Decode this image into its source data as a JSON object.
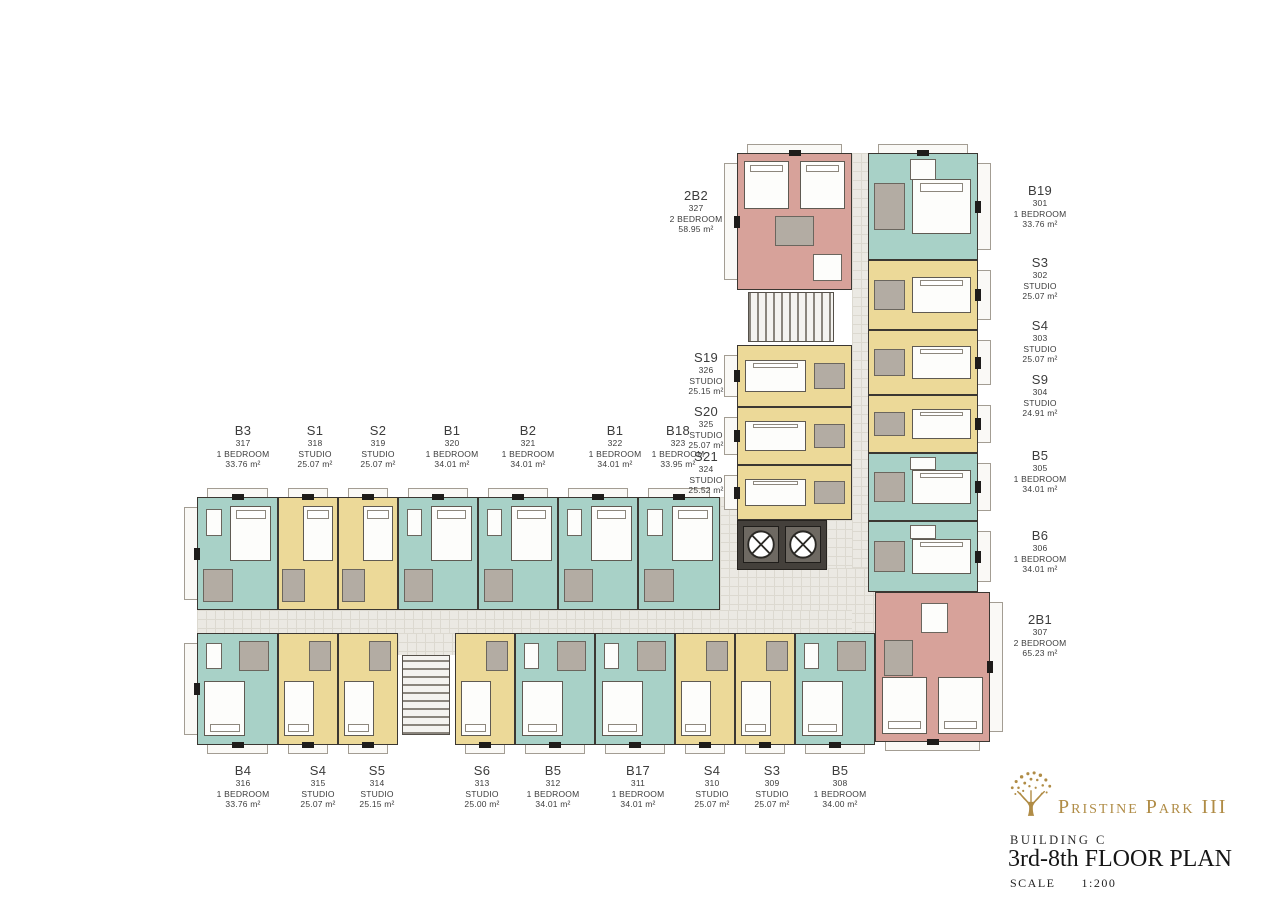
{
  "palette": {
    "teal": "#a8d1c7",
    "yellow": "#ecd998",
    "pink": "#d7a29a",
    "bath": "#b3aca3",
    "corridor": "#ebe9e3",
    "wall": "#3b3732",
    "gold": "#b08c46"
  },
  "title_block": {
    "project": "Pristine Park III",
    "building": "BUILDING C",
    "floor_plan": "3rd-8th FLOOR PLAN",
    "scale_label": "SCALE",
    "scale_value": "1:200"
  },
  "units": [
    {
      "code": "B19",
      "no": "301",
      "type": "1 BEDROOM",
      "area": "33.76 m²",
      "color": "teal",
      "side": "right",
      "tabs": [
        "top",
        "right"
      ],
      "block": {
        "x": 868,
        "y": 153,
        "w": 110,
        "h": 107
      },
      "label": {
        "cx": 1040,
        "y": 183
      }
    },
    {
      "code": "S3",
      "no": "302",
      "type": "STUDIO",
      "area": "25.07 m²",
      "color": "yellow",
      "side": "right",
      "tabs": [
        "right"
      ],
      "block": {
        "x": 868,
        "y": 260,
        "w": 110,
        "h": 70
      },
      "label": {
        "cx": 1040,
        "y": 255
      }
    },
    {
      "code": "S4",
      "no": "303",
      "type": "STUDIO",
      "area": "25.07 m²",
      "color": "yellow",
      "side": "right",
      "tabs": [
        "right"
      ],
      "block": {
        "x": 868,
        "y": 330,
        "w": 110,
        "h": 65
      },
      "label": {
        "cx": 1040,
        "y": 318
      }
    },
    {
      "code": "S9",
      "no": "304",
      "type": "STUDIO",
      "area": "24.91 m²",
      "color": "yellow",
      "side": "right",
      "tabs": [
        "right"
      ],
      "block": {
        "x": 868,
        "y": 395,
        "w": 110,
        "h": 58
      },
      "label": {
        "cx": 1040,
        "y": 372
      }
    },
    {
      "code": "B5",
      "no": "305",
      "type": "1 BEDROOM",
      "area": "34.01 m²",
      "color": "teal",
      "side": "right",
      "tabs": [
        "right"
      ],
      "block": {
        "x": 868,
        "y": 453,
        "w": 110,
        "h": 68
      },
      "label": {
        "cx": 1040,
        "y": 448
      }
    },
    {
      "code": "B6",
      "no": "306",
      "type": "1 BEDROOM",
      "area": "34.01 m²",
      "color": "teal",
      "side": "right",
      "tabs": [
        "right"
      ],
      "block": {
        "x": 868,
        "y": 521,
        "w": 110,
        "h": 71
      },
      "label": {
        "cx": 1040,
        "y": 528
      }
    },
    {
      "code": "2B1",
      "no": "307",
      "type": "2 BEDROOM",
      "area": "65.23 m²",
      "color": "pink",
      "side": "corner",
      "tabs": [
        "right",
        "bottom"
      ],
      "block": {
        "x": 875,
        "y": 592,
        "w": 115,
        "h": 150
      },
      "label": {
        "cx": 1040,
        "y": 612
      }
    },
    {
      "code": "B5",
      "no": "308",
      "type": "1 BEDROOM",
      "area": "34.00 m²",
      "color": "teal",
      "side": "bottom",
      "tabs": [
        "bottom"
      ],
      "block": {
        "x": 795,
        "y": 633,
        "w": 80,
        "h": 112
      },
      "label": {
        "cx": 840,
        "y": 763
      }
    },
    {
      "code": "S3",
      "no": "309",
      "type": "STUDIO",
      "area": "25.07 m²",
      "color": "yellow",
      "side": "bottom",
      "tabs": [
        "bottom"
      ],
      "block": {
        "x": 735,
        "y": 633,
        "w": 60,
        "h": 112
      },
      "label": {
        "cx": 772,
        "y": 763
      }
    },
    {
      "code": "S4",
      "no": "310",
      "type": "STUDIO",
      "area": "25.07 m²",
      "color": "yellow",
      "side": "bottom",
      "tabs": [
        "bottom"
      ],
      "block": {
        "x": 675,
        "y": 633,
        "w": 60,
        "h": 112
      },
      "label": {
        "cx": 712,
        "y": 763
      }
    },
    {
      "code": "B17",
      "no": "311",
      "type": "1 BEDROOM",
      "area": "34.01 m²",
      "color": "teal",
      "side": "bottom",
      "tabs": [
        "bottom"
      ],
      "block": {
        "x": 595,
        "y": 633,
        "w": 80,
        "h": 112
      },
      "label": {
        "cx": 638,
        "y": 763
      }
    },
    {
      "code": "B5",
      "no": "312",
      "type": "1 BEDROOM",
      "area": "34.01 m²",
      "color": "teal",
      "side": "bottom",
      "tabs": [
        "bottom"
      ],
      "block": {
        "x": 515,
        "y": 633,
        "w": 80,
        "h": 112
      },
      "label": {
        "cx": 553,
        "y": 763
      }
    },
    {
      "code": "S6",
      "no": "313",
      "type": "STUDIO",
      "area": "25.00 m²",
      "color": "yellow",
      "side": "bottom",
      "tabs": [
        "bottom"
      ],
      "block": {
        "x": 455,
        "y": 633,
        "w": 60,
        "h": 112
      },
      "label": {
        "cx": 482,
        "y": 763
      }
    },
    {
      "code": "S5",
      "no": "314",
      "type": "STUDIO",
      "area": "25.15 m²",
      "color": "yellow",
      "side": "bottom",
      "tabs": [
        "bottom"
      ],
      "block": {
        "x": 338,
        "y": 633,
        "w": 60,
        "h": 112
      },
      "label": {
        "cx": 377,
        "y": 763
      }
    },
    {
      "code": "S4",
      "no": "315",
      "type": "STUDIO",
      "area": "25.07 m²",
      "color": "yellow",
      "side": "bottom",
      "tabs": [
        "bottom"
      ],
      "block": {
        "x": 278,
        "y": 633,
        "w": 60,
        "h": 112
      },
      "label": {
        "cx": 318,
        "y": 763
      }
    },
    {
      "code": "B4",
      "no": "316",
      "type": "1 BEDROOM",
      "area": "33.76 m²",
      "color": "teal",
      "side": "bottom",
      "tabs": [
        "bottom",
        "left"
      ],
      "block": {
        "x": 197,
        "y": 633,
        "w": 81,
        "h": 112
      },
      "label": {
        "cx": 243,
        "y": 763
      }
    },
    {
      "code": "B3",
      "no": "317",
      "type": "1 BEDROOM",
      "area": "33.76 m²",
      "color": "teal",
      "side": "top",
      "tabs": [
        "top",
        "left"
      ],
      "block": {
        "x": 197,
        "y": 497,
        "w": 81,
        "h": 113
      },
      "label": {
        "cx": 243,
        "y": 423
      }
    },
    {
      "code": "S1",
      "no": "318",
      "type": "STUDIO",
      "area": "25.07 m²",
      "color": "yellow",
      "side": "top",
      "tabs": [
        "top"
      ],
      "block": {
        "x": 278,
        "y": 497,
        "w": 60,
        "h": 113
      },
      "label": {
        "cx": 315,
        "y": 423
      }
    },
    {
      "code": "S2",
      "no": "319",
      "type": "STUDIO",
      "area": "25.07 m²",
      "color": "yellow",
      "side": "top",
      "tabs": [
        "top"
      ],
      "block": {
        "x": 338,
        "y": 497,
        "w": 60,
        "h": 113
      },
      "label": {
        "cx": 378,
        "y": 423
      }
    },
    {
      "code": "B1",
      "no": "320",
      "type": "1 BEDROOM",
      "area": "34.01 m²",
      "color": "teal",
      "side": "top",
      "tabs": [
        "top"
      ],
      "block": {
        "x": 398,
        "y": 497,
        "w": 80,
        "h": 113
      },
      "label": {
        "cx": 452,
        "y": 423
      }
    },
    {
      "code": "B2",
      "no": "321",
      "type": "1 BEDROOM",
      "area": "34.01 m²",
      "color": "teal",
      "side": "top",
      "tabs": [
        "top"
      ],
      "block": {
        "x": 478,
        "y": 497,
        "w": 80,
        "h": 113
      },
      "label": {
        "cx": 528,
        "y": 423
      }
    },
    {
      "code": "B1",
      "no": "322",
      "type": "1 BEDROOM",
      "area": "34.01 m²",
      "color": "teal",
      "side": "top",
      "tabs": [
        "top"
      ],
      "block": {
        "x": 558,
        "y": 497,
        "w": 80,
        "h": 113
      },
      "label": {
        "cx": 615,
        "y": 423
      }
    },
    {
      "code": "B18",
      "no": "323",
      "type": "1 BEDROOM",
      "area": "33.95 m²",
      "color": "teal",
      "side": "top",
      "tabs": [
        "top"
      ],
      "block": {
        "x": 638,
        "y": 497,
        "w": 82,
        "h": 113
      },
      "label": {
        "cx": 678,
        "y": 423,
        "w": 70
      }
    },
    {
      "code": "S21",
      "no": "324",
      "type": "STUDIO",
      "area": "25.52 m²",
      "color": "yellow",
      "side": "left",
      "tabs": [
        "left"
      ],
      "block": {
        "x": 737,
        "y": 465,
        "w": 115,
        "h": 55
      },
      "label": {
        "cx": 706,
        "y": 449,
        "w": 70
      }
    },
    {
      "code": "S20",
      "no": "325",
      "type": "STUDIO",
      "area": "25.07 m²",
      "color": "yellow",
      "side": "left",
      "tabs": [
        "left"
      ],
      "block": {
        "x": 737,
        "y": 407,
        "w": 115,
        "h": 58
      },
      "label": {
        "cx": 706,
        "y": 404,
        "w": 70
      }
    },
    {
      "code": "S19",
      "no": "326",
      "type": "STUDIO",
      "area": "25.15 m²",
      "color": "yellow",
      "side": "left",
      "tabs": [
        "left"
      ],
      "block": {
        "x": 737,
        "y": 345,
        "w": 115,
        "h": 62
      },
      "label": {
        "cx": 706,
        "y": 350,
        "w": 70
      }
    },
    {
      "code": "2B2",
      "no": "327",
      "type": "2 BEDROOM",
      "area": "58.95 m²",
      "color": "pink",
      "side": "left",
      "tabs": [
        "left",
        "top"
      ],
      "block": {
        "x": 737,
        "y": 153,
        "w": 115,
        "h": 137
      },
      "label": {
        "cx": 696,
        "y": 188,
        "w": 86
      }
    }
  ],
  "structure": {
    "corridors": [
      {
        "x": 852,
        "y": 153,
        "w": 16,
        "h": 439
      },
      {
        "x": 720,
        "y": 497,
        "w": 17,
        "h": 113
      },
      {
        "x": 827,
        "y": 520,
        "w": 25,
        "h": 50
      },
      {
        "x": 720,
        "y": 568,
        "w": 156,
        "h": 65
      },
      {
        "x": 197,
        "y": 610,
        "w": 655,
        "h": 23
      },
      {
        "x": 398,
        "y": 633,
        "w": 57,
        "h": 22
      }
    ],
    "stairs": [
      {
        "x": 748,
        "y": 292,
        "w": 86,
        "h": 50,
        "dir": "h"
      },
      {
        "x": 402,
        "y": 655,
        "w": 48,
        "h": 80,
        "dir": "v"
      }
    ],
    "elevator_core": {
      "x": 737,
      "y": 520,
      "w": 90,
      "h": 50,
      "cars": 2
    }
  }
}
